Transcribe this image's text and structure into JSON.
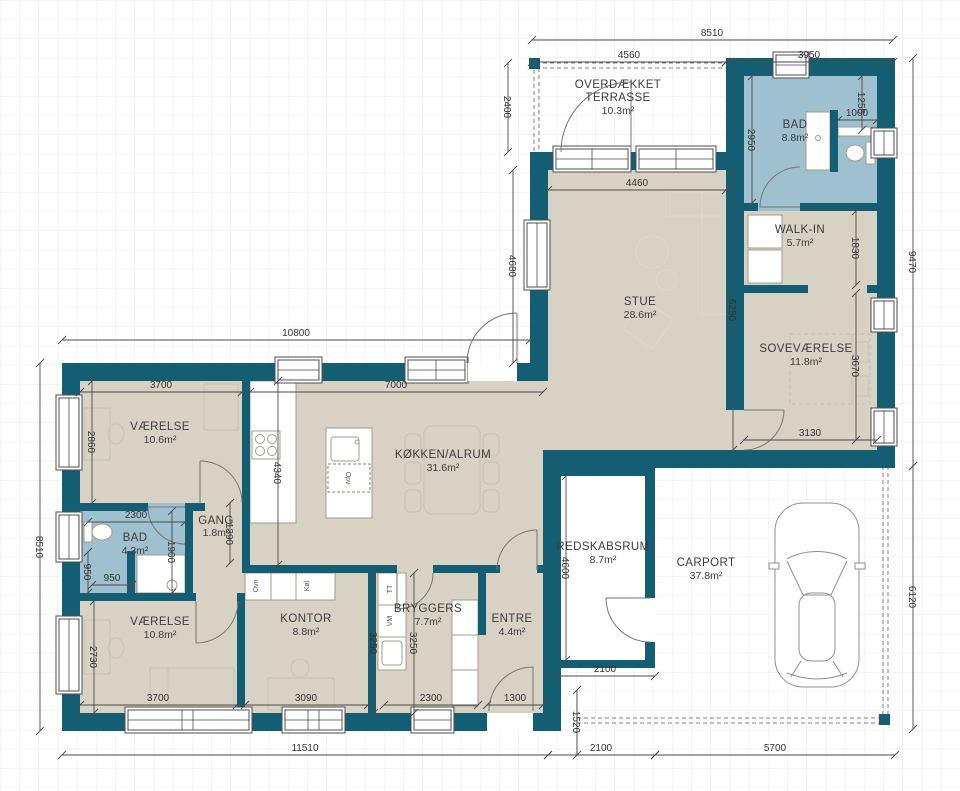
{
  "rooms": [
    {
      "id": "terrasse",
      "name_line1": "OVERDÆKKET",
      "name_line2": "TERRASSE",
      "area": "10.3m²"
    },
    {
      "id": "bad-top",
      "name": "BAD",
      "area": "8.8m²"
    },
    {
      "id": "walk-in",
      "name": "WALK-IN",
      "area": "5.7m²"
    },
    {
      "id": "stue",
      "name": "STUE",
      "area": "28.6m²"
    },
    {
      "id": "sovevaerelse",
      "name": "SOVEVÆRELSE",
      "area": "11.8m²"
    },
    {
      "id": "vaerelse-nv",
      "name": "VÆRELSE",
      "area": "10.6m²"
    },
    {
      "id": "koekken-alrum",
      "name": "KØKKEN/ALRUM",
      "area": "31.6m²"
    },
    {
      "id": "gang",
      "name": "GANG",
      "area": "1.8m²"
    },
    {
      "id": "bad-lille",
      "name": "BAD",
      "area": "4.3m²"
    },
    {
      "id": "vaerelse-sv",
      "name": "VÆRELSE",
      "area": "10.8m²"
    },
    {
      "id": "kontor",
      "name": "KONTOR",
      "area": "8.8m²"
    },
    {
      "id": "bryggers",
      "name": "BRYGGERS",
      "area": "7.7m²"
    },
    {
      "id": "entre",
      "name": "ENTRE",
      "area": "4.4m²"
    },
    {
      "id": "redskabsrum",
      "name": "REDSKABSRUM",
      "area": "8.7m²"
    },
    {
      "id": "carport",
      "name": "CARPORT",
      "area": "37.8m²"
    }
  ],
  "dims": {
    "top_total": "8510",
    "top_left": "4560",
    "top_right": "3950",
    "terrace_depth": "2400",
    "right_total": "9470",
    "carport_right": "6120",
    "left_total": "8510",
    "wing_top": "10800",
    "bottom_total": "11510",
    "bottom_redskab": "2100",
    "bottom_carport": "5700",
    "stue_width": "4460",
    "stue_left": "4680",
    "stue_right": "6250",
    "bad_top_depth": "2950",
    "bad_top_shelf": "1000",
    "bad_top_side": "1255",
    "walkin_depth": "1830",
    "sove_height": "3670",
    "sove_width": "3130",
    "vnv_width": "3700",
    "vnv_depth": "2860",
    "koekken_width": "7000",
    "koekken_depth": "4340",
    "gang_depth": "1390",
    "bad_width": "2300",
    "bad_depth": "1900",
    "bad_niche": "950",
    "bad_niche2": "950",
    "vsv_depth": "2730",
    "vsv_width": "3700",
    "kontor_width": "3090",
    "kontor_depth": "3250",
    "bryggers_depth": "3250",
    "bryggers_width": "2300",
    "entre_width": "1300",
    "entre_offset": "1520",
    "redskab_depth": "4600",
    "redskab_width": "2100"
  },
  "appliances": {
    "opv": "Opv",
    "ovn": "Ovn",
    "koel": "Køl",
    "tt": "TT",
    "vm": "VM"
  },
  "colors": {
    "wall": "#145e74",
    "floor": "#d8d2c4",
    "bath": "#9fc1cf",
    "dim_text": "#333333"
  }
}
